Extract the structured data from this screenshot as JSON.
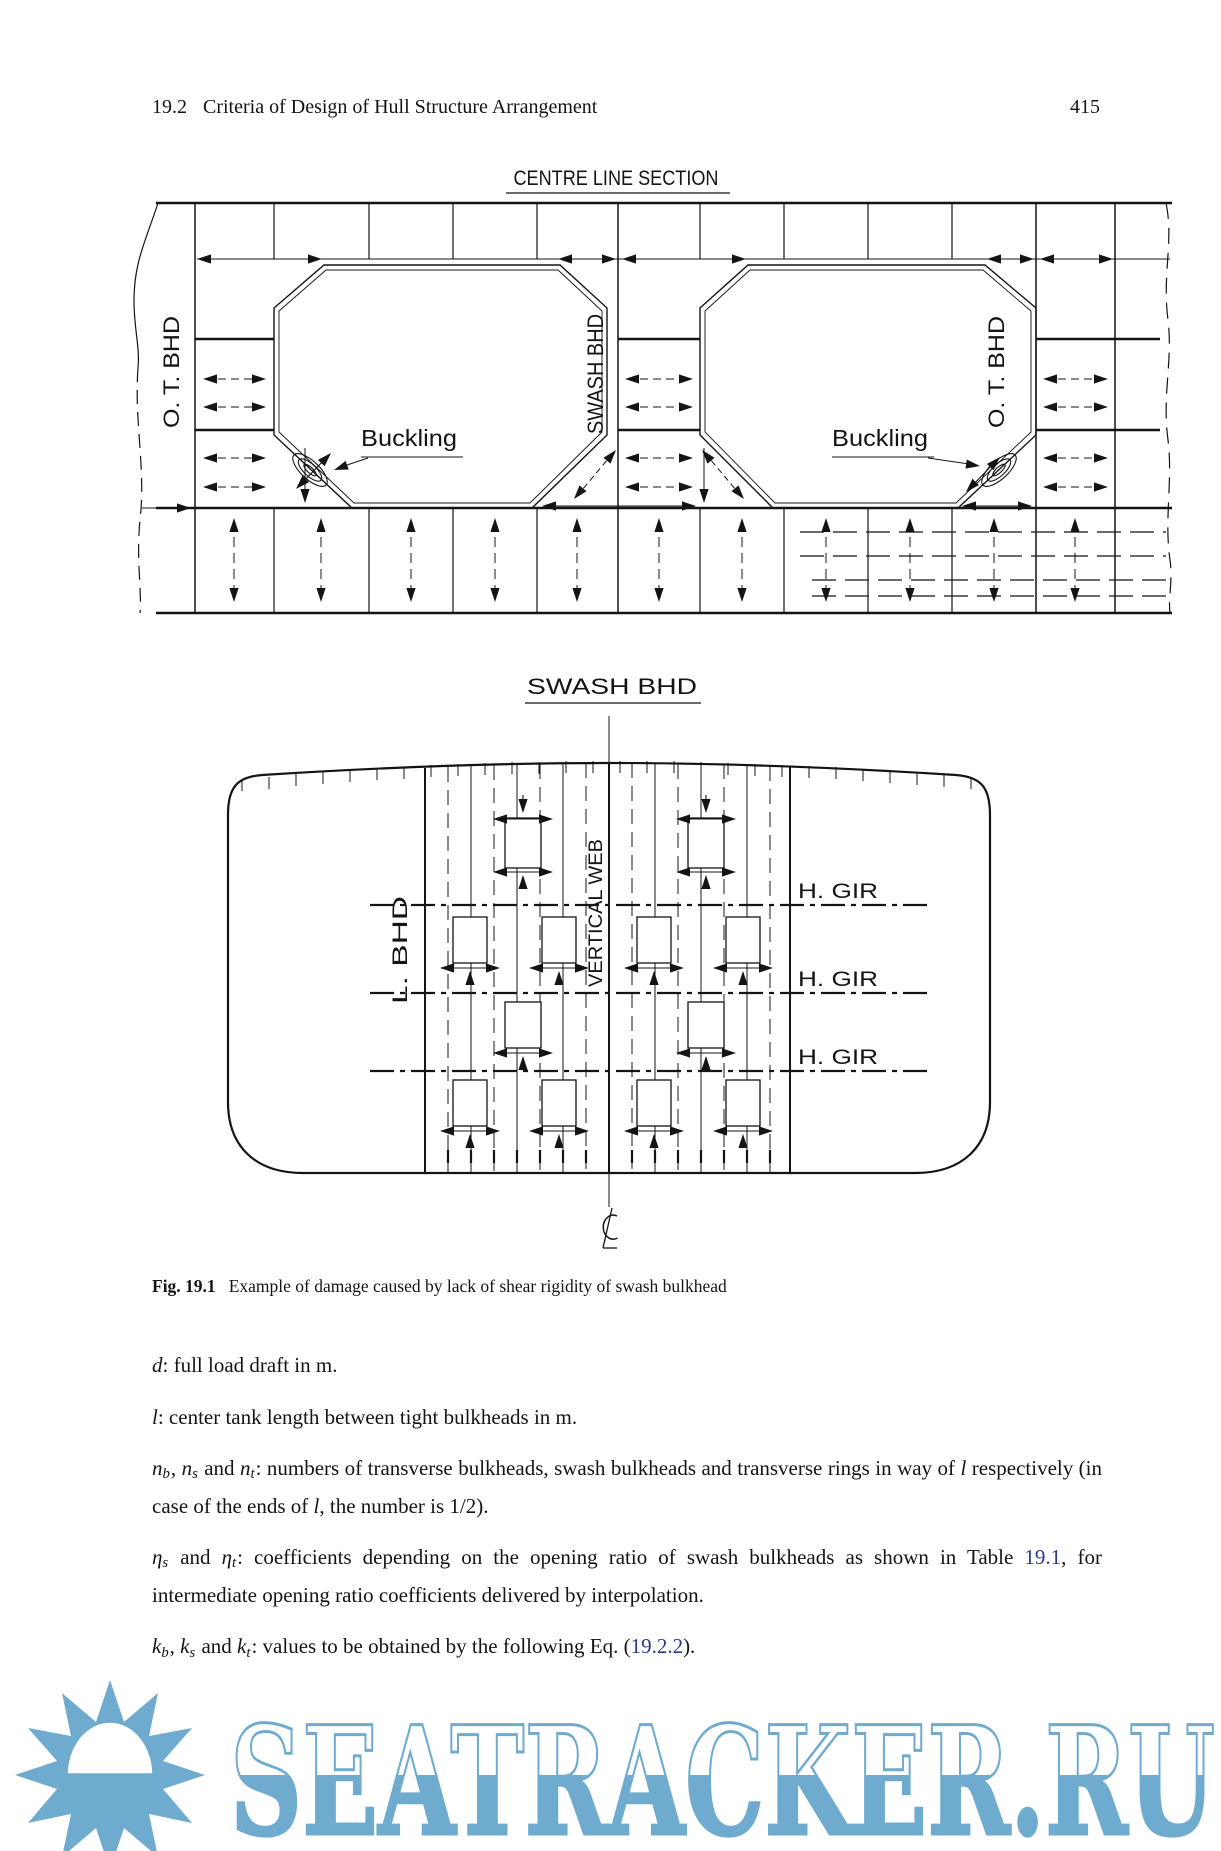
{
  "header": {
    "section": "19.2",
    "title": "Criteria of Design of Hull Structure Arrangement",
    "page_number": "415"
  },
  "figure1": {
    "title": "CENTRE LINE SECTION",
    "labels": {
      "ot_bhd_left": "O. T. BHD",
      "swash_bhd": "SWASH BHD",
      "ot_bhd_right": "O. T. BHD",
      "buckling_left": "Buckling",
      "buckling_right": "Buckling"
    }
  },
  "figure2": {
    "title": "SWASH BHD",
    "labels": {
      "l_bhd": "L. BHD",
      "vertical_web": "VERTICAL WEB",
      "h_gir_1": "H. GIR",
      "h_gir_2": "H. GIR",
      "h_gir_3": "H. GIR",
      "centreline_symbol": "℄"
    }
  },
  "caption": {
    "fig_label": "Fig. 19.1",
    "text": "Example of damage caused by lack of shear rigidity of swash bulkhead"
  },
  "paragraphs": {
    "p1": {
      "parts": [
        {
          "t": "d"
        },
        {
          "t": ": full load draft in m."
        }
      ]
    },
    "p2": {
      "parts": [
        {
          "t": "l"
        },
        {
          "t": ": center tank length between tight bulkheads in m."
        }
      ]
    },
    "p3": {
      "parts": [
        {
          "t": "n"
        },
        {
          "t": "b"
        },
        {
          "t": ", "
        },
        {
          "t": "n"
        },
        {
          "t": "s"
        },
        {
          "t": " and "
        },
        {
          "t": "n"
        },
        {
          "t": "t"
        },
        {
          "t": ": numbers of transverse bulkheads, swash bulkheads and transverse rings in way of "
        },
        {
          "t": "l"
        },
        {
          "t": " respectively (in case of the ends of "
        },
        {
          "t": "l"
        },
        {
          "t": ", the number is 1/2)."
        }
      ]
    },
    "p4": {
      "parts": [
        {
          "t": "η"
        },
        {
          "t": "s"
        },
        {
          "t": " and "
        },
        {
          "t": "η"
        },
        {
          "t": "t"
        },
        {
          "t": ": coefficients depending on the opening ratio of swash bulkheads as shown in Table "
        },
        {
          "t": "19.1"
        },
        {
          "t": ", for intermediate opening ratio coefficients delivered by interpolation."
        }
      ]
    },
    "p5": {
      "parts": [
        {
          "t": "k"
        },
        {
          "t": "b"
        },
        {
          "t": ", "
        },
        {
          "t": "k"
        },
        {
          "t": "s"
        },
        {
          "t": " and "
        },
        {
          "t": "k"
        },
        {
          "t": "t"
        },
        {
          "t": ": values to be obtained by the following Eq. ("
        },
        {
          "t": "19.2.2"
        },
        {
          "t": ")."
        }
      ]
    }
  },
  "watermark": {
    "text": "SEATRACKER.RU",
    "color": "#6fabce"
  },
  "colors": {
    "ink": "#141414",
    "link": "#2b3a8f",
    "watermark_blue": "#6fabce"
  }
}
